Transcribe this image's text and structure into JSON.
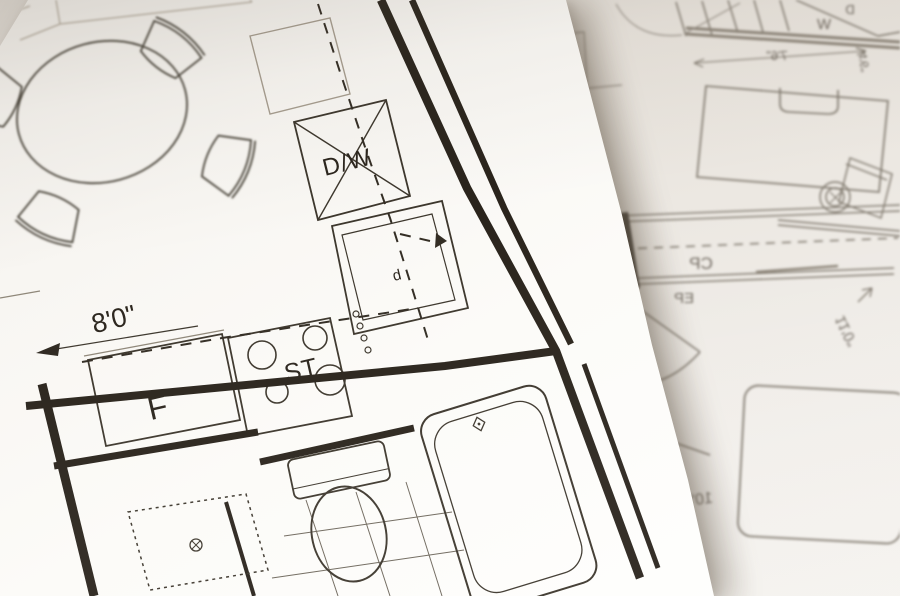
{
  "left_sheet": {
    "labels": {
      "dishwasher": "D/W",
      "sink_cabinet": "d",
      "stove": "ST",
      "refrigerator": "F"
    },
    "dimensions": {
      "kitchen_run": "8'0\""
    }
  },
  "right_sheet": {
    "labels": {
      "washer": "W",
      "dryer": "D",
      "closet": "CP",
      "entry_label": "EP",
      "small_room": "b"
    },
    "dimensions": {
      "top_width": "7'6\"",
      "top_side": "4'6\"",
      "upper_small": "6'0\"",
      "bedroom_width": "11'0\"",
      "bedroom_depth": "10'0\""
    }
  },
  "colors": {
    "ink": "#2e2820",
    "faint_ink": "#8f8779",
    "back_ink": "#7d766b",
    "paper_front": "#fcfbf8",
    "paper_back": "#e9e4de"
  }
}
